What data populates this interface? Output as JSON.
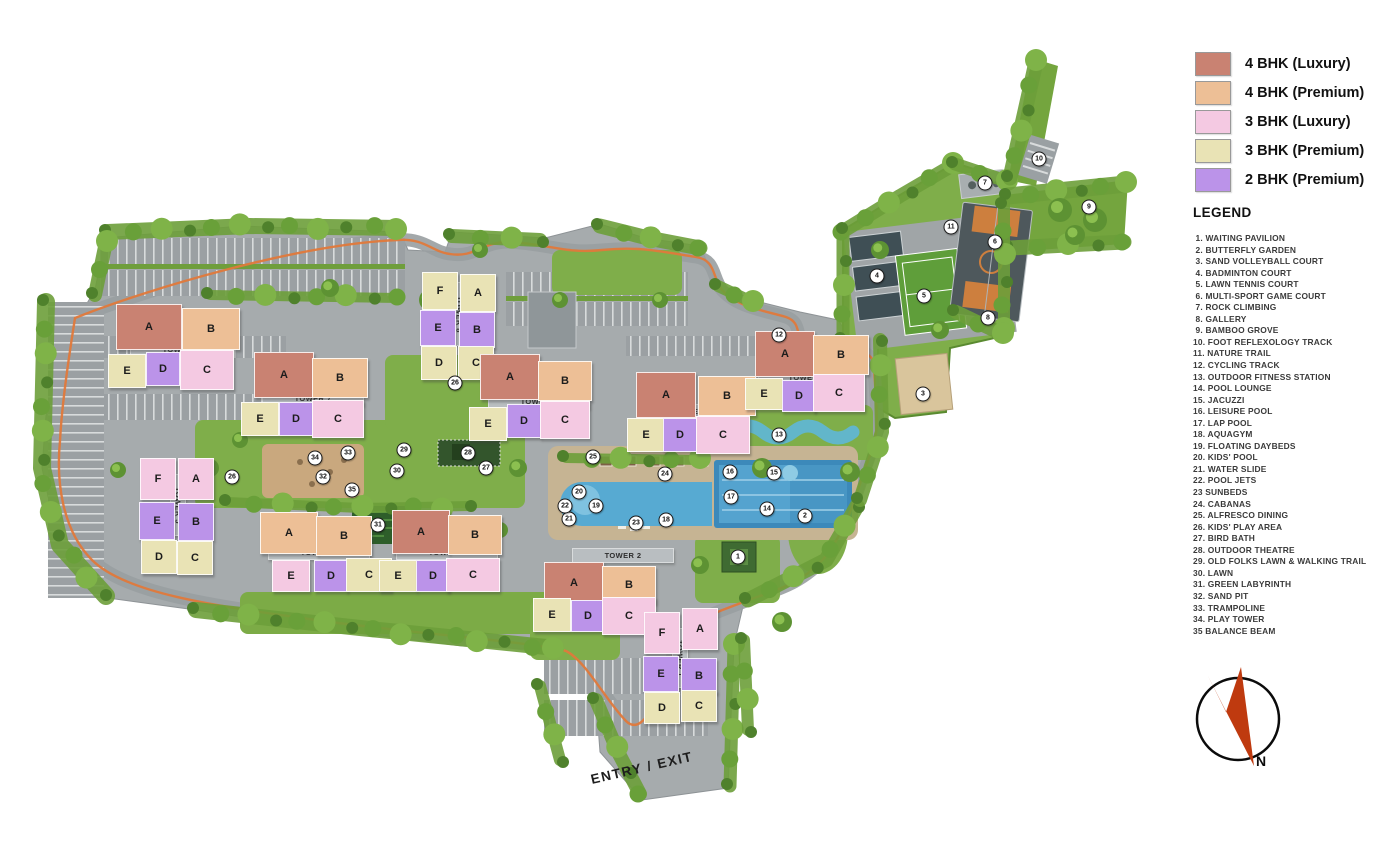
{
  "key": {
    "items": [
      {
        "code": "4L",
        "label": "4 BHK (Luxury)",
        "color": "#c98272"
      },
      {
        "code": "4P",
        "label": "4 BHK (Premium)",
        "color": "#edbf96"
      },
      {
        "code": "3L",
        "label": "3 BHK (Luxury)",
        "color": "#f4c9e2"
      },
      {
        "code": "3P",
        "label": "3 BHK (Premium)",
        "color": "#e9e3b5"
      },
      {
        "code": "2P",
        "label": "2 BHK (Premium)",
        "color": "#bb93e9"
      }
    ]
  },
  "legend": {
    "title": "LEGEND",
    "items": [
      " 1. WAITING PAVILION",
      " 2. BUTTERFLY GARDEN",
      " 3. SAND VOLLEYBALL COURT",
      " 4. BADMINTON COURT",
      " 5. LAWN TENNIS COURT",
      " 6. MULTI-SPORT GAME COURT",
      " 7. ROCK CLIMBING",
      " 8. GALLERY",
      " 9. BAMBOO GROVE",
      "10. FOOT REFLEXOLOGY TRACK",
      "11. NATURE TRAIL",
      "12. CYCLING TRACK",
      "13. OUTDOOR FITNESS STATION",
      "14. POOL LOUNGE",
      "15. JACUZZI",
      "16. LEISURE POOL",
      "17. LAP POOL",
      "18. AQUAGYM",
      "19. FLOATING DAYBEDS",
      "20. KIDS' POOL",
      "21. WATER SLIDE",
      "22. POOL JETS",
      "23 SUNBEDS",
      "24. CABANAS",
      "25. ALFRESCO DINING",
      "26. KIDS' PLAY AREA",
      "27. BIRD BATH",
      "28. OUTDOOR THEATRE",
      "29. OLD FOLKS LAWN & WALKING TRAIL",
      "30. LAWN",
      "31. GREEN LABYRINTH",
      "32. SAND PIT",
      "33. TRAMPOLINE",
      "34. PLAY TOWER",
      "35 BALANCE BEAM"
    ]
  },
  "site": {
    "entry_label": "ENTRY / EXIT",
    "compass_label": "N",
    "towers": [
      {
        "id": "tower-6",
        "label": "TOWER 6",
        "vertical": false,
        "label_box": [
          130,
          342,
          100,
          13
        ],
        "units": [
          {
            "letter": "A",
            "type": "4L",
            "box": [
              116,
              304,
              64,
              44
            ]
          },
          {
            "letter": "B",
            "type": "4P",
            "box": [
              182,
              308,
              56,
              40
            ]
          },
          {
            "letter": "E",
            "type": "3P",
            "box": [
              108,
              354,
              36,
              32
            ]
          },
          {
            "letter": "D",
            "type": "2P",
            "box": [
              146,
              352,
              32,
              32
            ]
          },
          {
            "letter": "C",
            "type": "3L",
            "box": [
              180,
              350,
              52,
              38
            ]
          }
        ]
      },
      {
        "id": "tower-7",
        "label": "TOWER 7",
        "vertical": false,
        "label_box": [
          262,
          391,
          100,
          13
        ],
        "units": [
          {
            "letter": "A",
            "type": "4L",
            "box": [
              254,
              352,
              58,
              44
            ]
          },
          {
            "letter": "B",
            "type": "4P",
            "box": [
              312,
              358,
              54,
              38
            ]
          },
          {
            "letter": "E",
            "type": "3P",
            "box": [
              241,
              402,
              36,
              32
            ]
          },
          {
            "letter": "D",
            "type": "2P",
            "box": [
              279,
              402,
              32,
              32
            ]
          },
          {
            "letter": "C",
            "type": "3L",
            "box": [
              312,
              400,
              50,
              36
            ]
          }
        ]
      },
      {
        "id": "tower-8",
        "label": "TOWER 8",
        "vertical": true,
        "label_box": [
          451,
          282,
          14,
          62
        ],
        "units": [
          {
            "letter": "F",
            "type": "3P",
            "box": [
              422,
              272,
              34,
              36
            ]
          },
          {
            "letter": "A",
            "type": "3P",
            "box": [
              460,
              274,
              34,
              36
            ]
          },
          {
            "letter": "E",
            "type": "2P",
            "box": [
              420,
              310,
              34,
              34
            ]
          },
          {
            "letter": "B",
            "type": "2P",
            "box": [
              459,
              312,
              34,
              34
            ]
          },
          {
            "letter": "D",
            "type": "3P",
            "box": [
              421,
              346,
              34,
              32
            ]
          },
          {
            "letter": "C",
            "type": "3P",
            "box": [
              458,
              346,
              34,
              32
            ]
          }
        ]
      },
      {
        "id": "tower-9",
        "label": "TOWER 9",
        "vertical": false,
        "label_box": [
          488,
          394,
          100,
          13
        ],
        "units": [
          {
            "letter": "A",
            "type": "4L",
            "box": [
              480,
              354,
              58,
              44
            ]
          },
          {
            "letter": "B",
            "type": "4P",
            "box": [
              538,
              361,
              52,
              38
            ]
          },
          {
            "letter": "E",
            "type": "3P",
            "box": [
              469,
              407,
              36,
              32
            ]
          },
          {
            "letter": "D",
            "type": "2P",
            "box": [
              507,
              404,
              32,
              32
            ]
          },
          {
            "letter": "C",
            "type": "3L",
            "box": [
              540,
              401,
              48,
              36
            ]
          }
        ]
      },
      {
        "id": "tower-10",
        "label": "TOWER 10",
        "vertical": false,
        "label_box": [
          644,
          404,
          100,
          13
        ],
        "units": [
          {
            "letter": "A",
            "type": "4L",
            "box": [
              636,
              372,
              58,
              44
            ]
          },
          {
            "letter": "B",
            "type": "4P",
            "box": [
              698,
              376,
              56,
              38
            ]
          },
          {
            "letter": "E",
            "type": "3P",
            "box": [
              627,
              418,
              36,
              32
            ]
          },
          {
            "letter": "D",
            "type": "2P",
            "box": [
              663,
              418,
              32,
              32
            ]
          },
          {
            "letter": "C",
            "type": "3L",
            "box": [
              696,
              416,
              52,
              36
            ]
          }
        ]
      },
      {
        "id": "tower-11",
        "label": "TOWER 11",
        "vertical": false,
        "label_box": [
          758,
          370,
          100,
          13
        ],
        "units": [
          {
            "letter": "A",
            "type": "4L",
            "box": [
              755,
              331,
              58,
              44
            ]
          },
          {
            "letter": "B",
            "type": "4P",
            "box": [
              813,
              335,
              54,
              38
            ]
          },
          {
            "letter": "E",
            "type": "3P",
            "box": [
              745,
              378,
              36,
              30
            ]
          },
          {
            "letter": "D",
            "type": "2P",
            "box": [
              782,
              380,
              32,
              30
            ]
          },
          {
            "letter": "C",
            "type": "3L",
            "box": [
              813,
              374,
              50,
              36
            ]
          }
        ]
      },
      {
        "id": "tower-5",
        "label": "TOWER 5",
        "vertical": true,
        "label_box": [
          170,
          474,
          14,
          60
        ],
        "units": [
          {
            "letter": "F",
            "type": "3L",
            "box": [
              140,
              458,
              34,
              40
            ]
          },
          {
            "letter": "A",
            "type": "3L",
            "box": [
              178,
              458,
              34,
              40
            ]
          },
          {
            "letter": "E",
            "type": "2P",
            "box": [
              139,
              502,
              34,
              36
            ]
          },
          {
            "letter": "B",
            "type": "2P",
            "box": [
              178,
              503,
              34,
              36
            ]
          },
          {
            "letter": "D",
            "type": "3P",
            "box": [
              141,
              540,
              34,
              32
            ]
          },
          {
            "letter": "C",
            "type": "3P",
            "box": [
              177,
              541,
              34,
              32
            ]
          }
        ]
      },
      {
        "id": "tower-4",
        "label": "TOWER 4",
        "vertical": false,
        "label_box": [
          268,
          545,
          100,
          13
        ],
        "units": [
          {
            "letter": "A",
            "type": "4P",
            "box": [
              260,
              512,
              56,
              40
            ]
          },
          {
            "letter": "B",
            "type": "4P",
            "box": [
              316,
              516,
              54,
              38
            ]
          },
          {
            "letter": "E",
            "type": "3L",
            "box": [
              272,
              560,
              36,
              30
            ]
          },
          {
            "letter": "D",
            "type": "2P",
            "box": [
              314,
              560,
              32,
              30
            ]
          },
          {
            "letter": "C",
            "type": "3P",
            "box": [
              346,
              558,
              44,
              32
            ]
          }
        ]
      },
      {
        "id": "tower-3",
        "label": "TOWER 3",
        "vertical": false,
        "label_box": [
          396,
          545,
          100,
          13
        ],
        "units": [
          {
            "letter": "A",
            "type": "4L",
            "box": [
              392,
              510,
              56,
              42
            ]
          },
          {
            "letter": "B",
            "type": "4P",
            "box": [
              448,
              515,
              52,
              38
            ]
          },
          {
            "letter": "E",
            "type": "3P",
            "box": [
              379,
              560,
              36,
              30
            ]
          },
          {
            "letter": "D",
            "type": "2P",
            "box": [
              416,
              560,
              32,
              30
            ]
          },
          {
            "letter": "C",
            "type": "3L",
            "box": [
              446,
              558,
              52,
              32
            ]
          }
        ]
      },
      {
        "id": "tower-2",
        "label": "TOWER 2",
        "vertical": false,
        "label_box": [
          572,
          548,
          100,
          13
        ],
        "units": [
          {
            "letter": "A",
            "type": "4L",
            "box": [
              544,
              562,
              58,
              40
            ]
          },
          {
            "letter": "B",
            "type": "4P",
            "box": [
              602,
              566,
              52,
              36
            ]
          },
          {
            "letter": "E",
            "type": "3P",
            "box": [
              533,
              598,
              36,
              32
            ]
          },
          {
            "letter": "D",
            "type": "2P",
            "box": [
              571,
              600,
              32,
              30
            ]
          },
          {
            "letter": "C",
            "type": "3L",
            "box": [
              602,
              597,
              52,
              36
            ]
          }
        ]
      },
      {
        "id": "tower-1",
        "label": "TOWER 1",
        "vertical": true,
        "label_box": [
          672,
          628,
          14,
          58
        ],
        "units": [
          {
            "letter": "F",
            "type": "3L",
            "box": [
              644,
              612,
              34,
              40
            ]
          },
          {
            "letter": "A",
            "type": "3L",
            "box": [
              682,
              608,
              34,
              40
            ]
          },
          {
            "letter": "E",
            "type": "2P",
            "box": [
              643,
              656,
              34,
              34
            ]
          },
          {
            "letter": "B",
            "type": "2P",
            "box": [
              681,
              658,
              34,
              34
            ]
          },
          {
            "letter": "D",
            "type": "3P",
            "box": [
              644,
              692,
              34,
              30
            ]
          },
          {
            "letter": "C",
            "type": "3P",
            "box": [
              681,
              690,
              34,
              30
            ]
          }
        ]
      }
    ],
    "markers": [
      {
        "n": 1,
        "x": 738,
        "y": 557
      },
      {
        "n": 2,
        "x": 805,
        "y": 516
      },
      {
        "n": 3,
        "x": 923,
        "y": 394
      },
      {
        "n": 4,
        "x": 877,
        "y": 276
      },
      {
        "n": 5,
        "x": 924,
        "y": 296
      },
      {
        "n": 6,
        "x": 995,
        "y": 242
      },
      {
        "n": 7,
        "x": 985,
        "y": 183
      },
      {
        "n": 8,
        "x": 988,
        "y": 318
      },
      {
        "n": 9,
        "x": 1089,
        "y": 207
      },
      {
        "n": 10,
        "x": 1039,
        "y": 159
      },
      {
        "n": 11,
        "x": 951,
        "y": 227
      },
      {
        "n": 12,
        "x": 779,
        "y": 335
      },
      {
        "n": 13,
        "x": 779,
        "y": 435
      },
      {
        "n": 14,
        "x": 767,
        "y": 509
      },
      {
        "n": 15,
        "x": 774,
        "y": 473
      },
      {
        "n": 16,
        "x": 730,
        "y": 472
      },
      {
        "n": 17,
        "x": 731,
        "y": 497
      },
      {
        "n": 18,
        "x": 666,
        "y": 520
      },
      {
        "n": 19,
        "x": 596,
        "y": 506
      },
      {
        "n": 20,
        "x": 579,
        "y": 492
      },
      {
        "n": 21,
        "x": 569,
        "y": 519
      },
      {
        "n": 22,
        "x": 565,
        "y": 506
      },
      {
        "n": 23,
        "x": 636,
        "y": 523
      },
      {
        "n": 24,
        "x": 665,
        "y": 474
      },
      {
        "n": 25,
        "x": 593,
        "y": 457
      },
      {
        "n": 26,
        "x": 455,
        "y": 383
      },
      {
        "n": 26,
        "x": 232,
        "y": 477
      },
      {
        "n": 27,
        "x": 486,
        "y": 468
      },
      {
        "n": 28,
        "x": 468,
        "y": 453
      },
      {
        "n": 29,
        "x": 404,
        "y": 450
      },
      {
        "n": 30,
        "x": 397,
        "y": 471
      },
      {
        "n": 31,
        "x": 378,
        "y": 525
      },
      {
        "n": 32,
        "x": 323,
        "y": 477
      },
      {
        "n": 33,
        "x": 348,
        "y": 453
      },
      {
        "n": 34,
        "x": 315,
        "y": 458
      },
      {
        "n": 35,
        "x": 352,
        "y": 490
      }
    ]
  }
}
